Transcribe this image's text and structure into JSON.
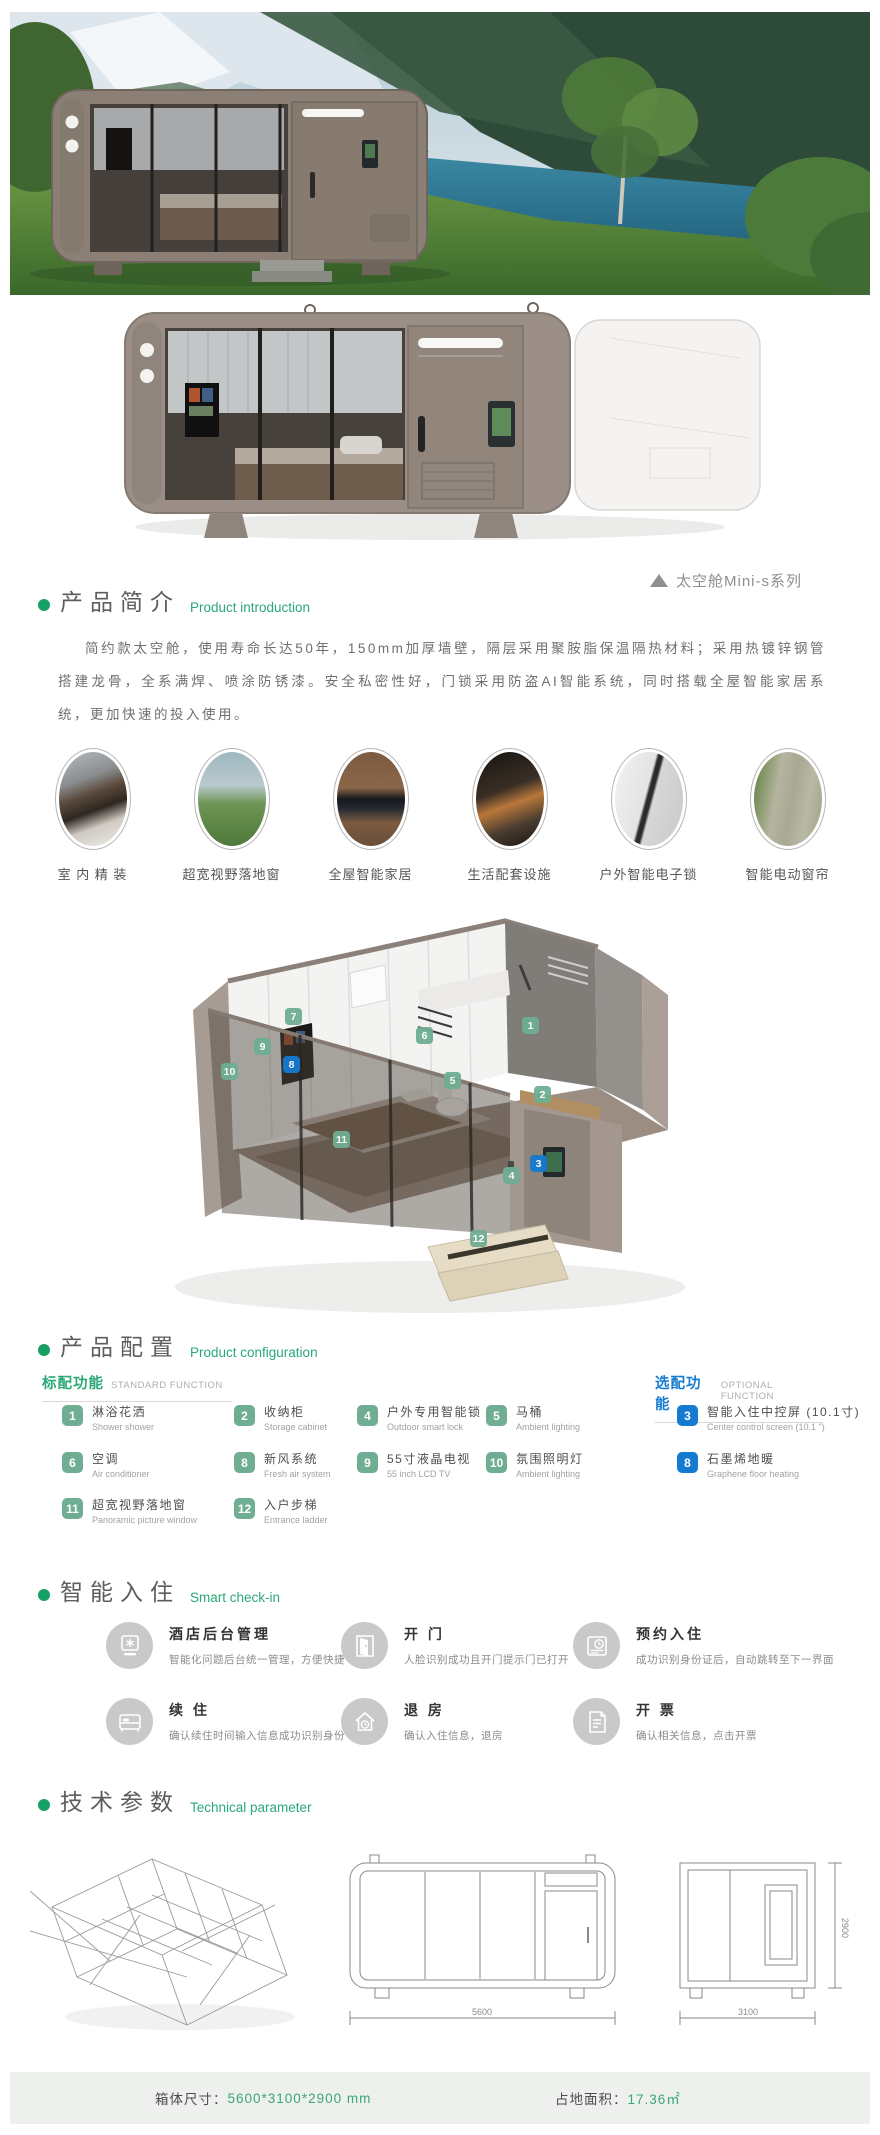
{
  "colors": {
    "accent_green": "#2aa876",
    "badge_green": "#6fae93",
    "accent_blue": "#147bd1",
    "footer_bg": "#eef0ee",
    "body_taupe": "#9a8e86"
  },
  "intro": {
    "title": "产品简介",
    "subtitle": "Product introduction",
    "series": "太空舱Mini-s系列",
    "paragraph": "简约款太空舱，使用寿命长达50年，150mm加厚墙壁，隔层采用聚胺脂保温隔热材料；采用热镀锌钢管搭建龙骨，全系满焊、喷涂防锈漆。安全私密性好，门锁采用防盗AI智能系统，同时搭载全屋智能家居系统，更加快速的投入使用。"
  },
  "features": [
    {
      "label": "室 内 精 装"
    },
    {
      "label": "超宽视野落地窗"
    },
    {
      "label": "全屋智能家居"
    },
    {
      "label": "生活配套设施"
    },
    {
      "label": "户外智能电子锁"
    },
    {
      "label": "智能电动窗帘"
    }
  ],
  "diagram": {
    "markers": [
      {
        "num": "1"
      },
      {
        "num": "2"
      },
      {
        "num": "3"
      },
      {
        "num": "4"
      },
      {
        "num": "5"
      },
      {
        "num": "6"
      },
      {
        "num": "7"
      },
      {
        "num": "8"
      },
      {
        "num": "9"
      },
      {
        "num": "10"
      },
      {
        "num": "11"
      },
      {
        "num": "12"
      }
    ]
  },
  "config": {
    "title": "产品配置",
    "subtitle": "Product configuration",
    "standard_label": "标配功能",
    "standard_label_en": "STANDARD FUNCTION",
    "optional_label": "选配功能",
    "optional_label_en": "OPTIONAL FUNCTION",
    "standard_items": [
      {
        "num": "1",
        "zh": "淋浴花洒",
        "en": "Shower shower"
      },
      {
        "num": "2",
        "zh": "收纳柜",
        "en": "Storage cabinet"
      },
      {
        "num": "4",
        "zh": "户外专用智能锁",
        "en": "Outdoor smart lock"
      },
      {
        "num": "5",
        "zh": "马桶",
        "en": "Ambient lighting"
      },
      {
        "num": "6",
        "zh": "空调",
        "en": "Air conditioner"
      },
      {
        "num": "8",
        "zh": "新风系统",
        "en": "Fresh air system"
      },
      {
        "num": "9",
        "zh": "55寸液晶电视",
        "en": "55 inch LCD TV"
      },
      {
        "num": "10",
        "zh": "氛围照明灯",
        "en": "Ambient lighting"
      },
      {
        "num": "11",
        "zh": "超宽视野落地窗",
        "en": "Panoramic picture window"
      },
      {
        "num": "12",
        "zh": "入户步梯",
        "en": "Entrance ladder"
      }
    ],
    "optional_items": [
      {
        "num": "3",
        "zh": "智能入住中控屏 (10.1寸)",
        "en": "Center control screen (10.1 \")"
      },
      {
        "num": "8",
        "zh": "石墨烯地暖",
        "en": "Graphene floor heating"
      }
    ]
  },
  "checkin": {
    "title": "智能入住",
    "subtitle": "Smart check-in",
    "items": [
      {
        "icon": "hotel-admin-icon",
        "title": "酒店后台管理",
        "desc": "智能化问题后台统一管理，方便快捷"
      },
      {
        "icon": "door-open-icon",
        "title": "开 门",
        "desc": "人脸识别成功且开门提示门已打开"
      },
      {
        "icon": "booking-clock-icon",
        "title": "预约入住",
        "desc": "成功识别身份证后，自动跳转至下一界面"
      },
      {
        "icon": "bed-icon",
        "title": "续 住",
        "desc": "确认续住时间输入信息成功识别身份"
      },
      {
        "icon": "house-clock-icon",
        "title": "退 房",
        "desc": "确认入住信息，退房"
      },
      {
        "icon": "invoice-icon",
        "title": "开 票",
        "desc": "确认相关信息，点击开票"
      }
    ]
  },
  "tech": {
    "title": "技术参数",
    "subtitle": "Technical parameter",
    "dims": {
      "length": "5600",
      "width": "3100",
      "height": "2900"
    }
  },
  "footer": {
    "size_label": "箱体尺寸：",
    "size_value": "5600*3100*2900 mm",
    "area_label": "占地面积：",
    "area_value": "17.36㎡"
  }
}
